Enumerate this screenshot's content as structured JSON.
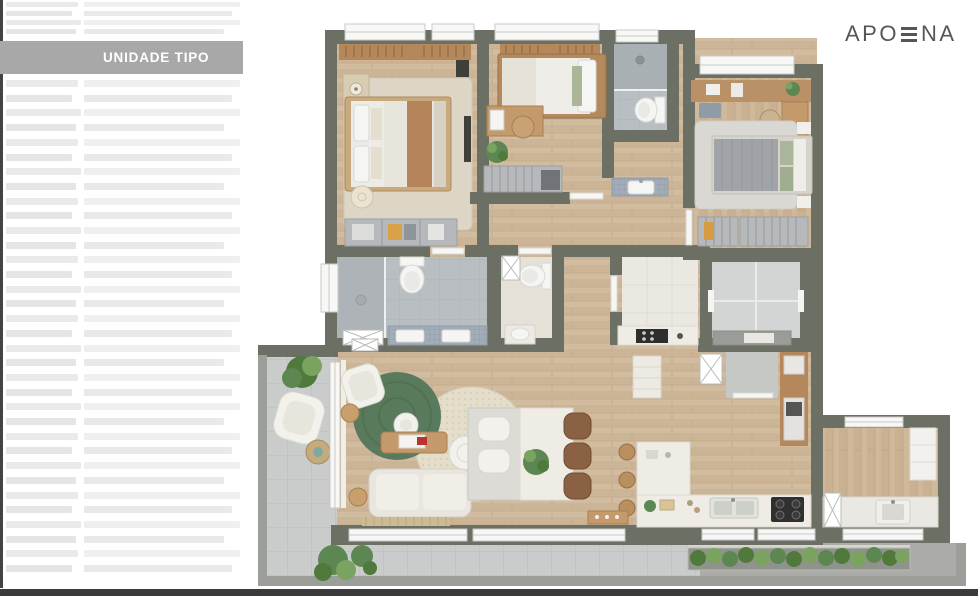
{
  "window": {
    "width": 978,
    "height": 596,
    "background": "#ffffff",
    "bottom_bar_color": "#3a3b3a"
  },
  "sidebar": {
    "banner": {
      "label": "UNIDADE TIPO",
      "bg": "#a8a8a8",
      "text_color": "#ffffff"
    },
    "placeholder_line_color": "#ebebeb",
    "left_edge_color": "#434343"
  },
  "brand": {
    "logo_text": "APOENA",
    "logo_prefix": "APO",
    "logo_suffix": "NA",
    "stylized_letter": "E-rendered-as-three-horizontal-bars",
    "color": "#55565a"
  },
  "floorplan": {
    "description": "Top-down rendered apartment floor plan (unidade tipo)",
    "colors": {
      "wall": "#6c7064",
      "wood_floor": "#d2bc9f",
      "bath_tile": "#b9bec2",
      "shower_tile": "#a9b0b4",
      "mosaic_counter": "#a3adb9",
      "balcony_tile": "#c9cccb",
      "walkway_concrete": "#abaca8",
      "marble": "#ebe8e2",
      "parapet": "#9c9f99",
      "rug_green": "#597a5c",
      "rug_beige": "#ddd6c6",
      "furniture_wood": "#c49a6c",
      "furniture_white": "#f0efe9",
      "bed_gray": "#a0a3a7",
      "plant_green": "#577d45",
      "stove_black": "#2f302f"
    },
    "rooms": [
      "master-bedroom",
      "bedroom-2",
      "bathroom-2",
      "bedroom-3",
      "master-bathroom",
      "lavatory",
      "hall-utility",
      "elevator-shaft",
      "living-room",
      "dining-area",
      "kitchen",
      "service-area",
      "balcony",
      "terrace-walkway",
      "planter"
    ]
  }
}
